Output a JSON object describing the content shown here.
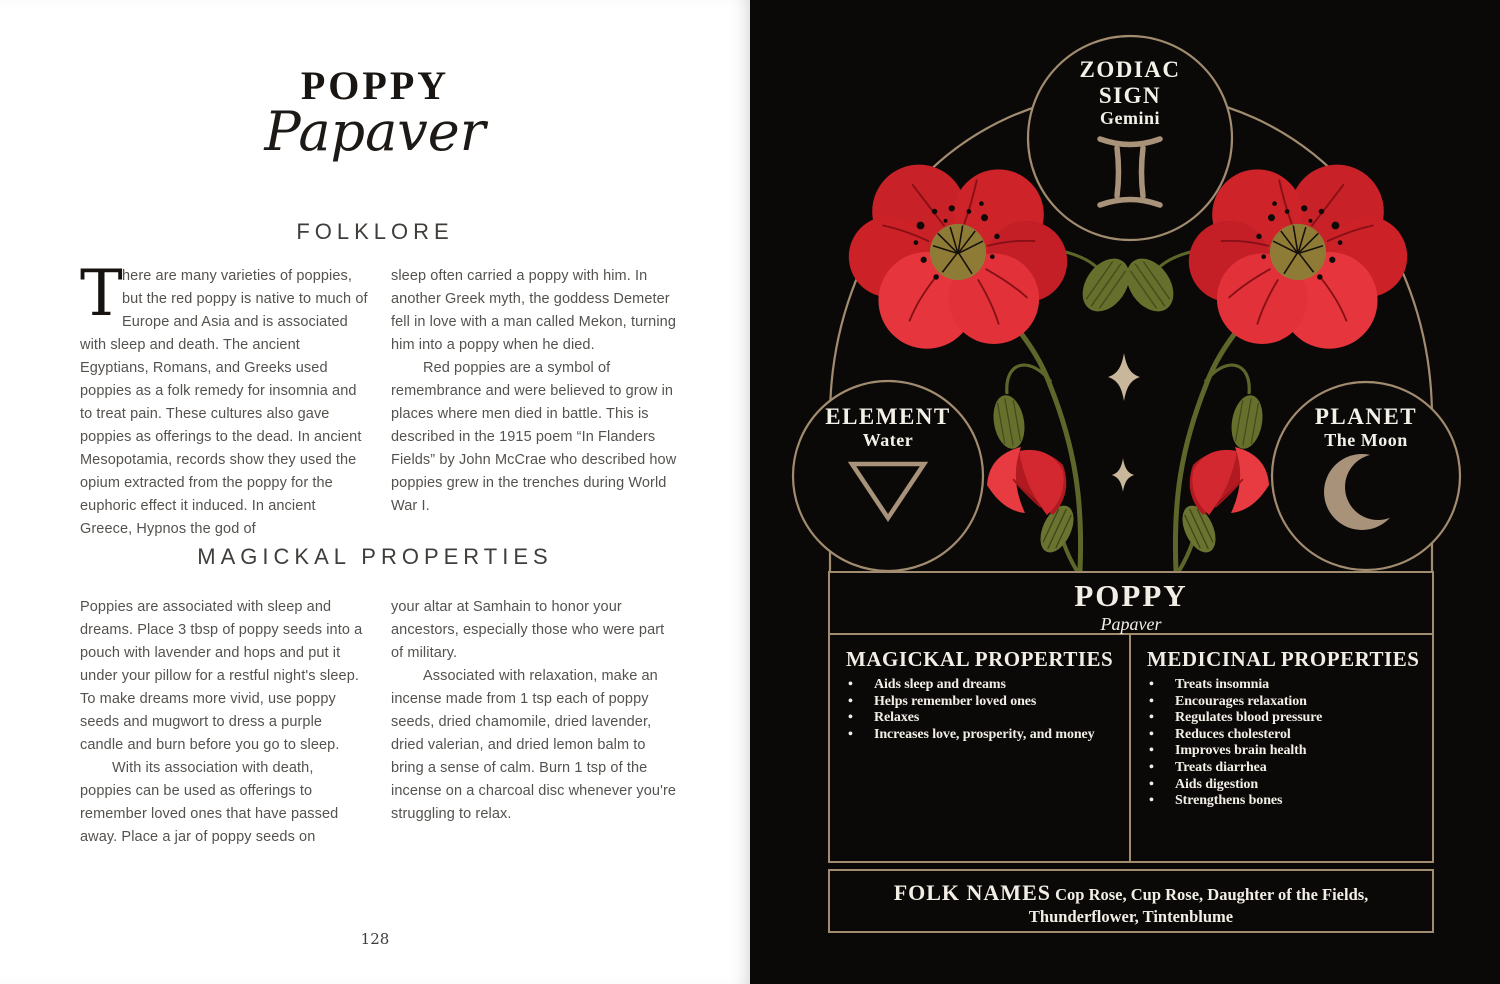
{
  "colors": {
    "page_black": "#0b0908",
    "line_tan": "#a28c70",
    "text_cream": "#f2eee6",
    "poppy_red": "#c82128",
    "poppy_bright_red": "#e7353d",
    "stem_green": "#5d672a",
    "pod_olive": "#66702c",
    "flower_center_gold": "#8e7b35",
    "sparkle_tan": "#c9b79c",
    "left_text_gray": "#55524e"
  },
  "left_page": {
    "title": "POPPY",
    "latin": "Papaver",
    "page_number": "128",
    "folklore": {
      "heading": "FOLKLORE",
      "drop_cap": "T",
      "col1_rest": "here are many varieties of poppies, but the red poppy is native to much of Europe and Asia and is associated with sleep and death. The ancient Egyptians, Romans, and Greeks used poppies as a folk remedy for insomnia and to treat pain. These cultures also gave poppies as offerings to the dead. In ancient Mesopotamia, records show they used the opium extracted from the poppy for the euphoric effect it induced. In ancient Greece, Hypnos the god of",
      "col2_p1": "sleep often carried a poppy with him. In another Greek myth, the goddess Demeter fell in love with a man called Mekon, turning him into a poppy when he died.",
      "col2_p2": "Red poppies are a symbol of remembrance and were believed to grow in places where men died in battle. This is described in the 1915 poem “In Flanders Fields” by John McCrae who described how poppies grew in the trenches during World War I."
    },
    "magickal": {
      "heading": "MAGICKAL PROPERTIES",
      "col1_p1": "Poppies are associated with sleep and dreams. Place 3 tbsp of poppy seeds into a pouch with lavender and hops and put it under your pillow for a restful night's sleep. To make dreams more vivid, use poppy seeds and mugwort to dress a purple candle and burn before you go to sleep.",
      "col1_p2": "With its association with death, poppies can be used as offerings to remember loved ones that have passed away. Place a jar of poppy seeds on",
      "col2_p1": "your altar at Samhain to honor your ancestors, especially those who were part of military.",
      "col2_p2": "Associated with relaxation, make an incense made from 1 tsp each of poppy seeds, dried chamomile, dried lavender, dried valerian, and dried lemon balm to bring a sense of calm. Burn 1 tsp of the incense on a charcoal disc whenever you're struggling to relax."
    }
  },
  "right_page": {
    "zodiac": {
      "label_line1": "ZODIAC",
      "label_line2": "SIGN",
      "value": "Gemini"
    },
    "element": {
      "label": "ELEMENT",
      "value": "Water"
    },
    "planet": {
      "label": "PLANET",
      "value": "The Moon"
    },
    "title_box": {
      "name": "POPPY",
      "latin": "Papaver"
    },
    "magickal_box": {
      "heading": "MAGICKAL PROPERTIES",
      "items": [
        "Aids sleep and dreams",
        "Helps remember loved ones",
        "Relaxes",
        "Increases love, prosperity, and money"
      ]
    },
    "medicinal_box": {
      "heading": "MEDICINAL PROPERTIES",
      "items": [
        "Treats insomnia",
        "Encourages relaxation",
        "Regulates blood pressure",
        "Reduces cholesterol",
        "Improves brain health",
        "Treats diarrhea",
        "Aids digestion",
        "Strengthens bones"
      ]
    },
    "folk_names": {
      "heading": "FOLK NAMES",
      "value": "Cop Rose, Cup Rose, Daughter of the Fields, Thunderflower, Tintenblume"
    }
  }
}
